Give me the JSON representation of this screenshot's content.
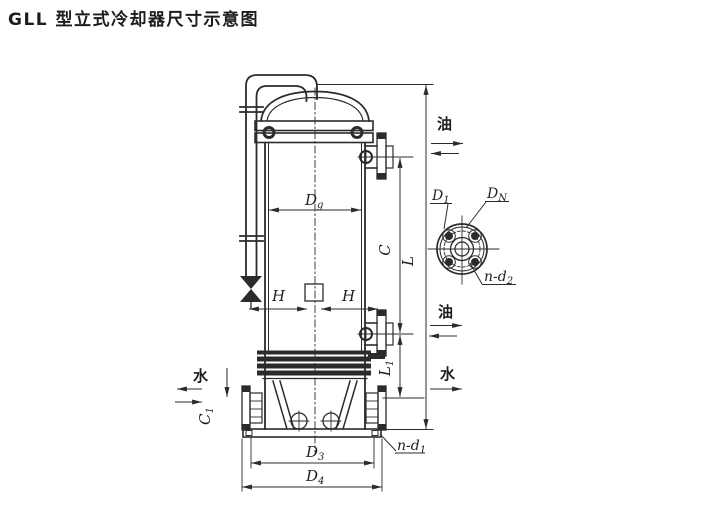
{
  "title": "GLL 型立式冷却器尺寸示意图",
  "colors": {
    "ink": "#2b2b2b",
    "background": "#ffffff"
  },
  "dimensions": {
    "dg": {
      "base": "D",
      "sub": "g"
    },
    "h_left": "H",
    "h_right": "H",
    "c": "C",
    "l": "L",
    "l1": {
      "base": "L",
      "sub": "1"
    },
    "c1": {
      "base": "C",
      "sub": "1"
    },
    "d3": {
      "base": "D",
      "sub": "3"
    },
    "d4": {
      "base": "D",
      "sub": "4"
    },
    "n_d1": {
      "base": "n-d",
      "sub": "1"
    }
  },
  "flange_detail": {
    "d1": {
      "base": "D",
      "sub": "1"
    },
    "dn": {
      "base": "D",
      "sub": "N"
    },
    "n_d2": {
      "base": "n-d",
      "sub": "2"
    }
  },
  "flow_labels": {
    "oil_top": "油",
    "oil_middle": "油",
    "water_right": "水",
    "water_left": "水"
  }
}
